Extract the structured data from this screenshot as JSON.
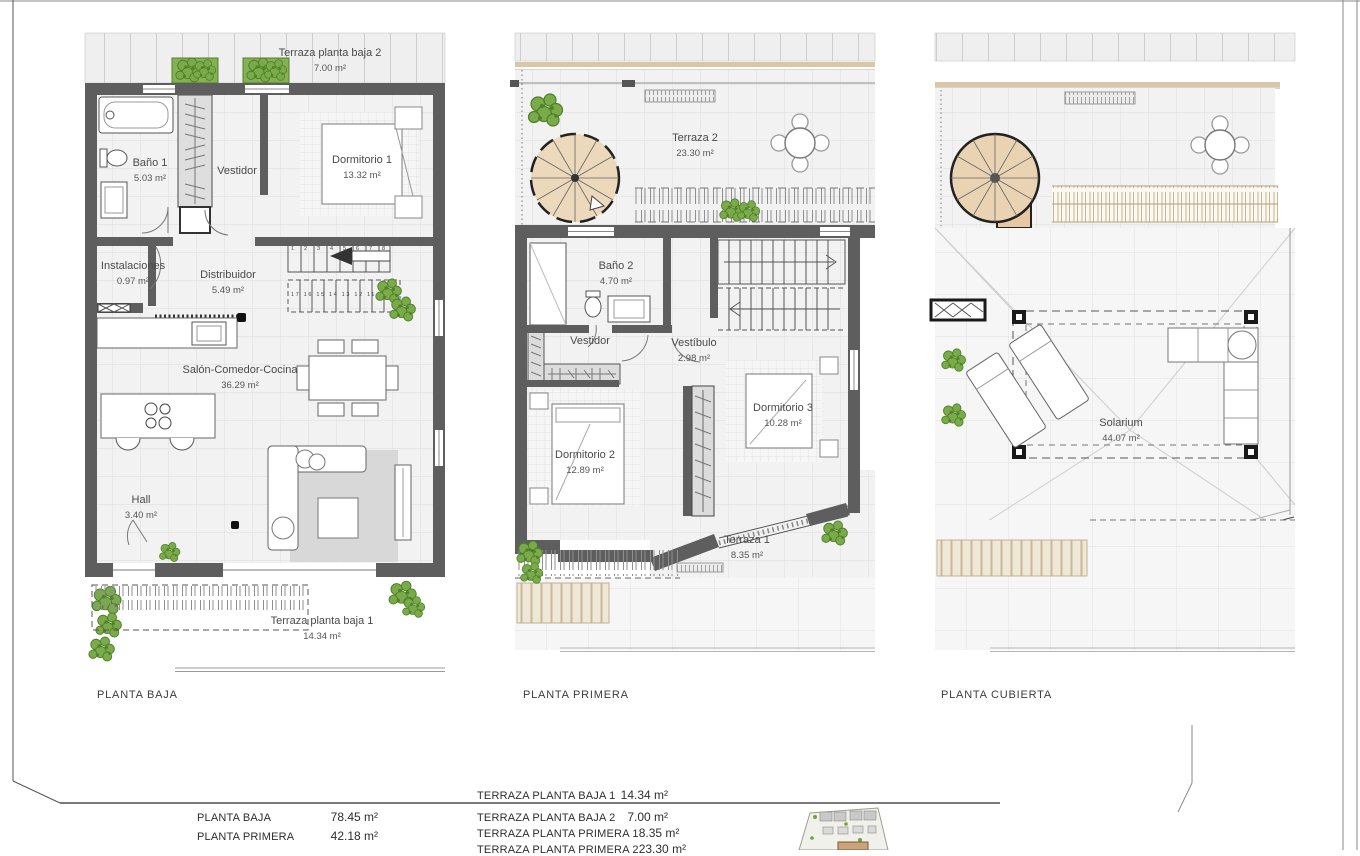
{
  "plans": {
    "baja": {
      "title": "PLANTA BAJA",
      "rooms": [
        {
          "name": "Terraza planta baja 2",
          "area": "7.00 m²"
        },
        {
          "name": "Baño 1",
          "area": "5.03 m²"
        },
        {
          "name": "Vestidor",
          "area": ""
        },
        {
          "name": "Dormitorio 1",
          "area": "13.32 m²"
        },
        {
          "name": "Instalaciones",
          "area": "0.97 m²"
        },
        {
          "name": "Distribuidor",
          "area": "5.49 m²"
        },
        {
          "name": "Salón-Comedor-Cocina",
          "area": "36.29 m²"
        },
        {
          "name": "Hall",
          "area": "3.40 m²"
        },
        {
          "name": "Terraza planta baja 1",
          "area": "14.34 m²"
        }
      ],
      "stair_numbers_up": "1 2 3 4 5 6 7 8",
      "stair_numbers_down": "17 16 15 14 13 12 11 10 9"
    },
    "primera": {
      "title": "PLANTA PRIMERA",
      "rooms": [
        {
          "name": "Terraza 2",
          "area": "23.30 m²"
        },
        {
          "name": "Baño 2",
          "area": "4.70 m²"
        },
        {
          "name": "Vestidor",
          "area": ""
        },
        {
          "name": "Vestíbulo",
          "area": "2.98 m²"
        },
        {
          "name": "Dormitorio 2",
          "area": "12.89 m²"
        },
        {
          "name": "Dormitorio 3",
          "area": "10.28 m²"
        },
        {
          "name": "Terraza 1",
          "area": "8.35 m²"
        }
      ]
    },
    "cubierta": {
      "title": "PLANTA CUBIERTA",
      "rooms": [
        {
          "name": "Solarium",
          "area": "44.07 m²"
        }
      ]
    }
  },
  "summary": {
    "left": [
      {
        "label": "PLANTA BAJA",
        "value": "78.45 m²"
      },
      {
        "label": "PLANTA PRIMERA",
        "value": "42.18 m²"
      }
    ],
    "right": [
      {
        "label": "TERRAZA PLANTA BAJA 1",
        "value": "14.34 m²"
      },
      {
        "label": "TERRAZA PLANTA BAJA 2",
        "value": "7.00 m²"
      },
      {
        "label": "TERRAZA PLANTA PRIMERA 1",
        "value": "8.35 m²"
      },
      {
        "label": "TERRAZA PLANTA PRIMERA 2",
        "value": "23.30 m²"
      }
    ]
  },
  "colors": {
    "wall": "#5e5e5e",
    "wood": "#e9d3b3",
    "plant": "#7aab4a",
    "floor": "#f2f2f2"
  }
}
